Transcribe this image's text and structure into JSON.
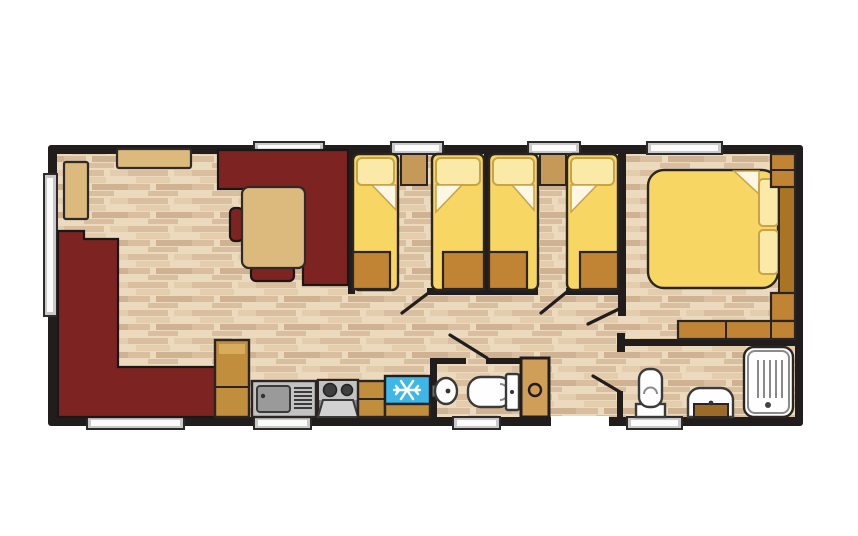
{
  "canvas": {
    "width": 858,
    "height": 536
  },
  "plan": {
    "kind": "holiday-home-floor-plan",
    "palette": {
      "background": "#ffffff",
      "wall": "#221d1d",
      "floor_base": "#ecdabf",
      "floor_strip": "#d9bfa0",
      "floor_strip_soft": "#e3cdad",
      "floor_strip_deep": "#cfb292",
      "sofa": "#7d2321",
      "furniture_tan": "#dcb97d",
      "bedside_tan": "#c59a58",
      "storage_tan": "#c08434",
      "cabinet_tan": "#c18e3e",
      "cabinet_tan_light": "#d8ab5d",
      "bed_yellow": "#f7d664",
      "pillow_yellow": "#fae9a7",
      "pillow_outline": "#c8a348",
      "fold_white": "#fdf7e4",
      "headboard_brown": "#aa7523",
      "appliance_gray": "#c2c2c2",
      "appliance_gray_dark": "#9a9a9a",
      "cooker_base_gray": "#8f8f8f",
      "oven_gray": "#d2d2d2",
      "burner_dark": "#3f3f3f",
      "fridge_blue": "#3eb7e8",
      "snowflake_white": "#ffffff",
      "fixture_white": "#fefefe",
      "fixture_outline": "#3a3a3a",
      "fixture_detail": "#8a8a8a",
      "vanity_brown": "#9c6b28",
      "window_frame": "#c9c9c9",
      "window_glass": "#fbfbfb",
      "door_panel_tan": "#cf9f5a"
    },
    "rooms": [
      {
        "name": "lounge",
        "fixtures": [
          "corner-sofa",
          "wall-shelf",
          "top-shelf"
        ]
      },
      {
        "name": "dining-area",
        "fixtures": [
          "l-shaped-bench",
          "dining-table",
          "chair"
        ]
      },
      {
        "name": "kitchen",
        "fixtures": [
          "tall-cabinet",
          "sink-drainer",
          "cooker-hob-oven",
          "worktop",
          "fridge-freezer"
        ]
      },
      {
        "name": "twin-bedroom-1",
        "fixtures": [
          "single-bed",
          "single-bed",
          "bedside-cabinet",
          "foot-storage",
          "foot-storage"
        ]
      },
      {
        "name": "twin-bedroom-2",
        "fixtures": [
          "single-bed",
          "single-bed",
          "bedside-cabinet",
          "foot-storage",
          "foot-storage"
        ]
      },
      {
        "name": "double-bedroom",
        "fixtures": [
          "double-bed",
          "headboard",
          "wardrobe",
          "bedside-cabinet",
          "drawer-unit"
        ]
      },
      {
        "name": "wc",
        "fixtures": [
          "basin",
          "toilet",
          "cupboard-door"
        ]
      },
      {
        "name": "shower-room",
        "fixtures": [
          "toilet",
          "vanity-basin",
          "shower-tray"
        ]
      }
    ],
    "window_count": 9,
    "door_count": 5
  }
}
